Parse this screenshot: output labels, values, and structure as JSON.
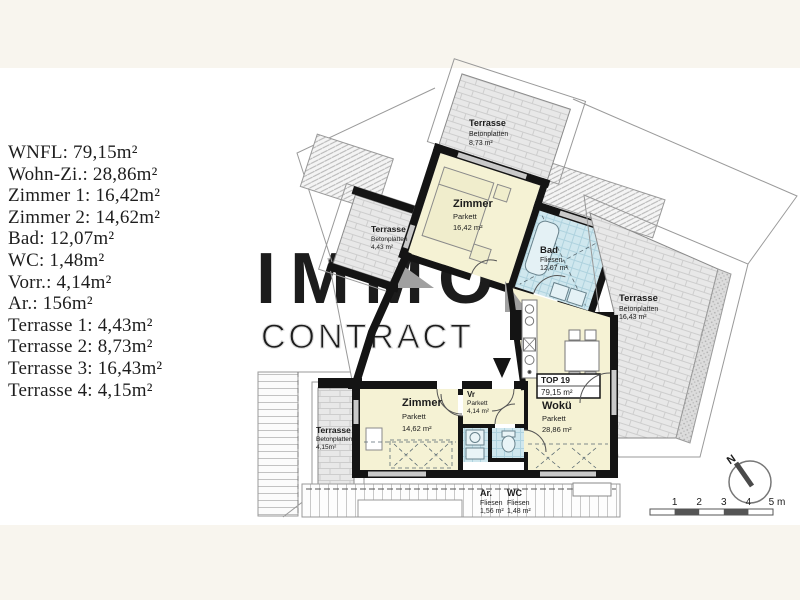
{
  "page": {
    "background": "#ffffff",
    "band_color": "#f8f5ee"
  },
  "watermark": {
    "line1": "IMMO",
    "line2": "CONTRACT",
    "fill_color": "#eeeeee",
    "outline_color": "#dcdcdc"
  },
  "area_list": {
    "items": [
      "WNFL: 79,15m²",
      "Wohn-Zi.: 28,86m²",
      "Zimmer 1: 16,42m²",
      "Zimmer 2: 14,62m²",
      "Bad: 12,07m²",
      "WC: 1,48m²",
      "Vorr.: 4,14m²",
      "Ar.: 156m²",
      "Terrasse 1: 4,43m²",
      "Terrasse 2: 8,73m²",
      "Terrasse 3: 16,43m²",
      "Terrasse 4: 4,15m²"
    ]
  },
  "plan": {
    "unit_label": {
      "title": "TOP 19",
      "area": "79,15 m²"
    },
    "rooms": [
      {
        "id": "zimmer-1",
        "name": "Zimmer",
        "floor": "Parkett",
        "area": "16,42 m²"
      },
      {
        "id": "zimmer-2",
        "name": "Zimmer",
        "floor": "Parkett",
        "area": "14,62 m²"
      },
      {
        "id": "bad",
        "name": "Bad",
        "floor": "Fliesen",
        "area": "12,07 m²"
      },
      {
        "id": "wokue",
        "name": "Wokü",
        "floor": "Parkett",
        "area": "28,86 m²"
      },
      {
        "id": "vorraum",
        "name": "Vr",
        "floor": "Parkett",
        "area": "4,14 m²"
      },
      {
        "id": "abstellraum",
        "name": "Ar.",
        "floor": "Fliesen",
        "area": "1,56 m²"
      },
      {
        "id": "wc",
        "name": "WC",
        "floor": "Fliesen",
        "area": "1,48 m²"
      },
      {
        "id": "terrasse-top",
        "name": "Terrasse",
        "floor": "Betonplatten",
        "area": "8,73 m²"
      },
      {
        "id": "terrasse-left",
        "name": "Terrasse",
        "floor": "Betonplatten",
        "area": "4,43 m²"
      },
      {
        "id": "terrasse-right",
        "name": "Terrasse",
        "floor": "Betonplatten",
        "area": "16,43 m²"
      },
      {
        "id": "terrasse-bottom",
        "name": "Terrasse",
        "floor": "Betonplatten",
        "area": "4,15m²"
      }
    ],
    "compass": {
      "north_label": "N"
    },
    "scale_bar": {
      "ticks": [
        "1",
        "2",
        "3",
        "4"
      ],
      "end_label": "5 m"
    },
    "colors": {
      "wall": "#141414",
      "room_fill": "#f5f2d4",
      "wet_room_fill": "#cfe7ee",
      "terrace_fill": "#e8e8e8",
      "window_band": "#c9c9c9"
    }
  }
}
